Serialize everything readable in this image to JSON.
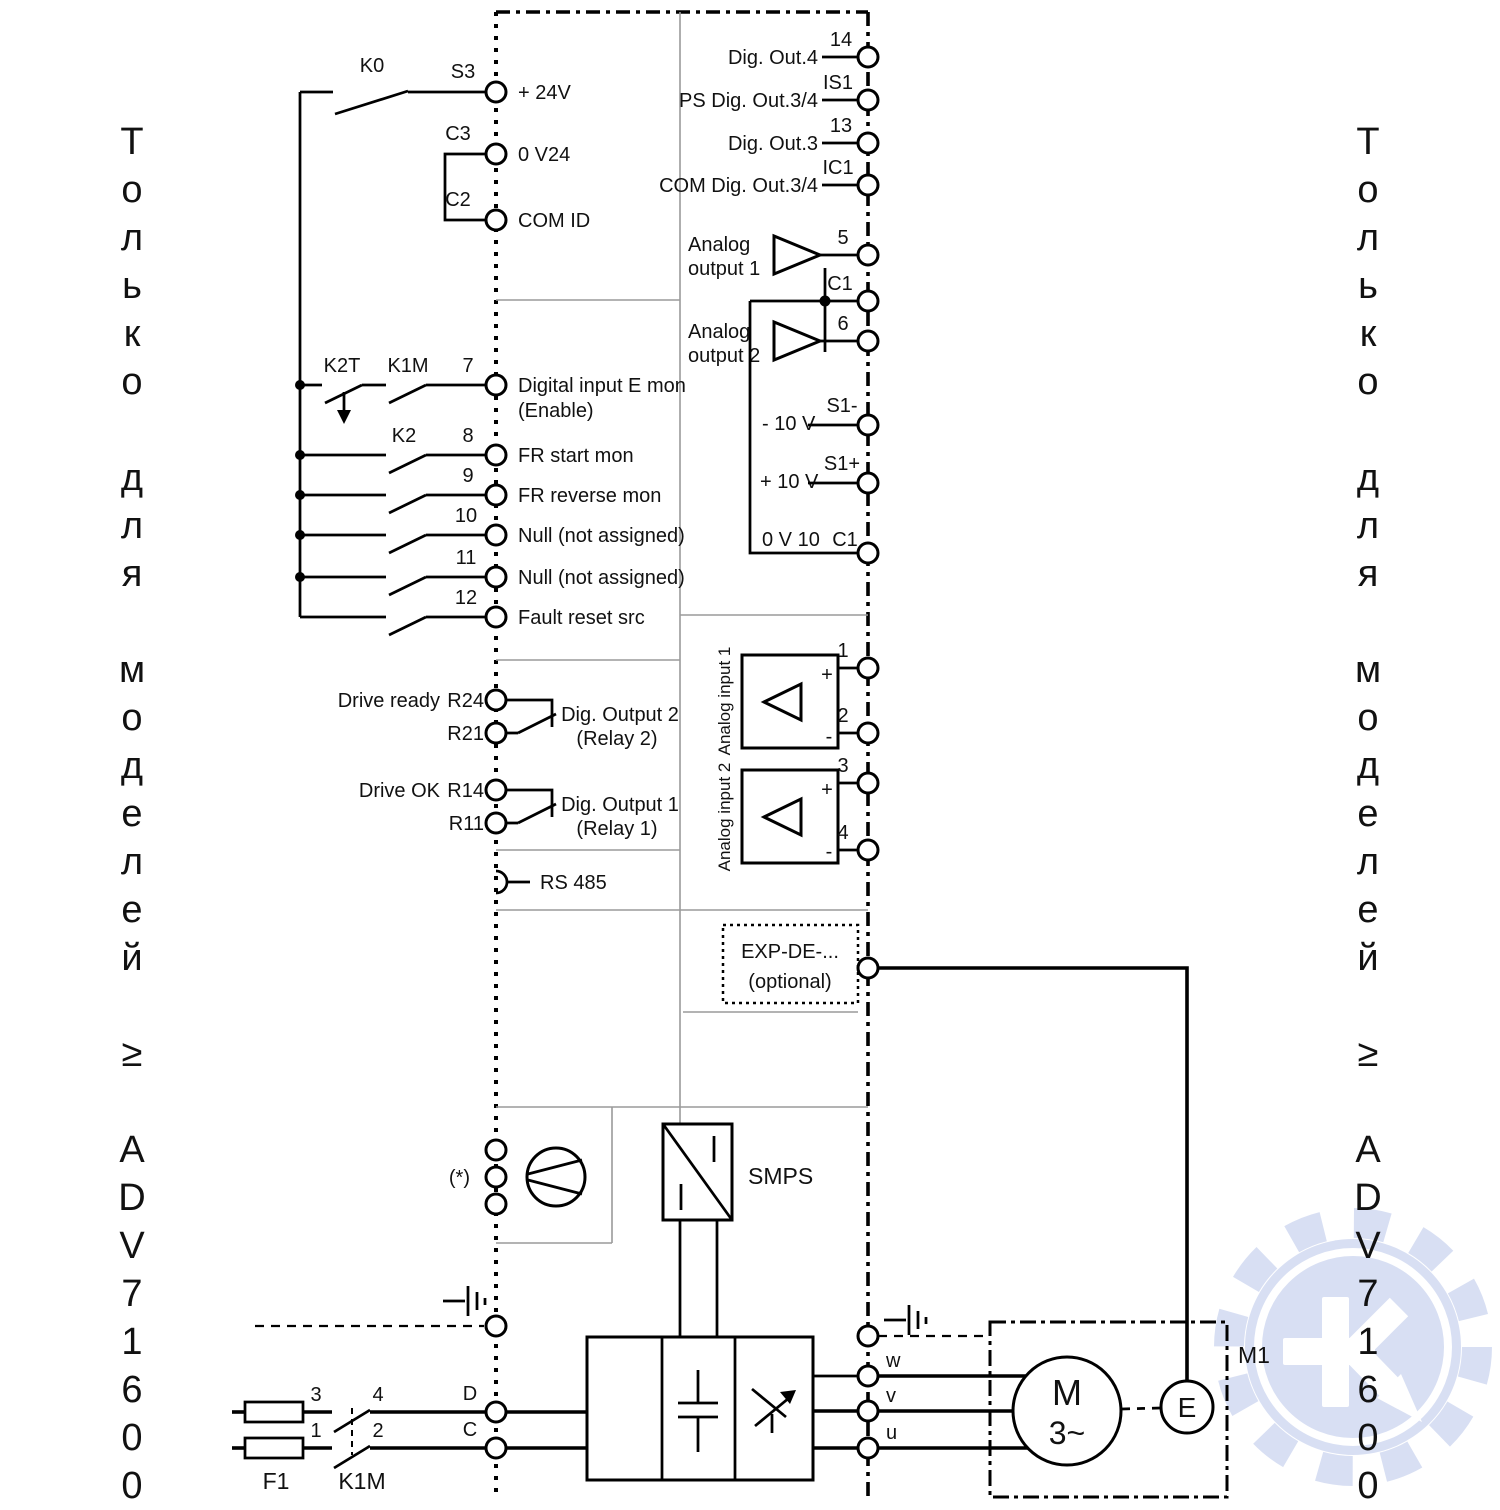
{
  "side_note": {
    "left": "Т\nо\nл\nь\nк\nо\n\nд\nл\nя\n\nм\nо\nд\nе\nл\nе\nй\n\n≥\n\nA\nD\nV\n7\n1\n6\n0\n0",
    "right": "Т\nо\nл\nь\nк\nо\n\nд\nл\nя\n\nм\nо\nд\nе\nл\nе\nй\n\n≥\n\nA\nD\nV\n7\n1\n6\n0\n0"
  },
  "supply": {
    "k0": "K0",
    "s3": "S3",
    "plus24": "+ 24V",
    "c3": "C3",
    "zerov24": "0 V24",
    "c2": "C2",
    "com_id": "COM ID"
  },
  "digital_inputs": [
    {
      "num": "7",
      "sw1": "K2T",
      "sw2": "K1M",
      "label": "Digital input E mon",
      "label2": "(Enable)"
    },
    {
      "num": "8",
      "sw2": "K2",
      "label": "FR start mon"
    },
    {
      "num": "9",
      "label": "FR reverse mon"
    },
    {
      "num": "10",
      "label": "Null (not assigned)"
    },
    {
      "num": "11",
      "label": "Null (not assigned)"
    },
    {
      "num": "12",
      "label": "Fault reset src"
    }
  ],
  "relays": [
    {
      "state": "Drive ready",
      "top": "R24",
      "bottom": "R21",
      "label": "Dig. Output 2",
      "label2": "(Relay 2)"
    },
    {
      "state": "Drive OK",
      "top": "R14",
      "bottom": "R11",
      "label": "Dig. Output 1",
      "label2": "(Relay 1)"
    }
  ],
  "comm": {
    "rs485": "RS 485"
  },
  "digital_outputs": [
    {
      "label": "Dig. Out.4",
      "term": "14"
    },
    {
      "label": "PS Dig. Out.3/4",
      "term": "IS1"
    },
    {
      "label": "Dig. Out.3",
      "term": "13"
    },
    {
      "label": "COM Dig. Out.3/4",
      "term": "IC1"
    }
  ],
  "analog_out": {
    "a1_line1": "Analog",
    "a1_line2": "output 1",
    "t5": "5",
    "c1_top": "C1",
    "a2_line1": "Analog",
    "a2_line2": "output 2",
    "t6": "6",
    "minus10": "- 10 V",
    "s1_minus": "S1-",
    "plus10": "+ 10 V",
    "s1_plus": "S1+",
    "zerov10": "0 V 10",
    "c1_bottom": "C1"
  },
  "analog_in": [
    {
      "label": "Analog input 1",
      "plus": "+",
      "minus": "-",
      "tp": "1",
      "tm": "2"
    },
    {
      "label": "Analog input 2",
      "plus": "+",
      "minus": "-",
      "tp": "3",
      "tm": "4"
    }
  ],
  "expansion": {
    "line1": "EXP-DE-...",
    "line2": "(optional)"
  },
  "power": {
    "star": "(*)",
    "smps": "SMPS",
    "f1": "F1",
    "k1m": "K1M",
    "n1": "1",
    "n2": "2",
    "n3": "3",
    "n4": "4",
    "d": "D",
    "c": "C",
    "w": "w",
    "v": "v",
    "u": "u"
  },
  "motor": {
    "m": "M",
    "phases": "3~",
    "encoder": "E",
    "tag": "M1"
  },
  "colors": {
    "watermark": "#b9c6ea",
    "line": "#000000",
    "partition": "#9a9a9a"
  }
}
